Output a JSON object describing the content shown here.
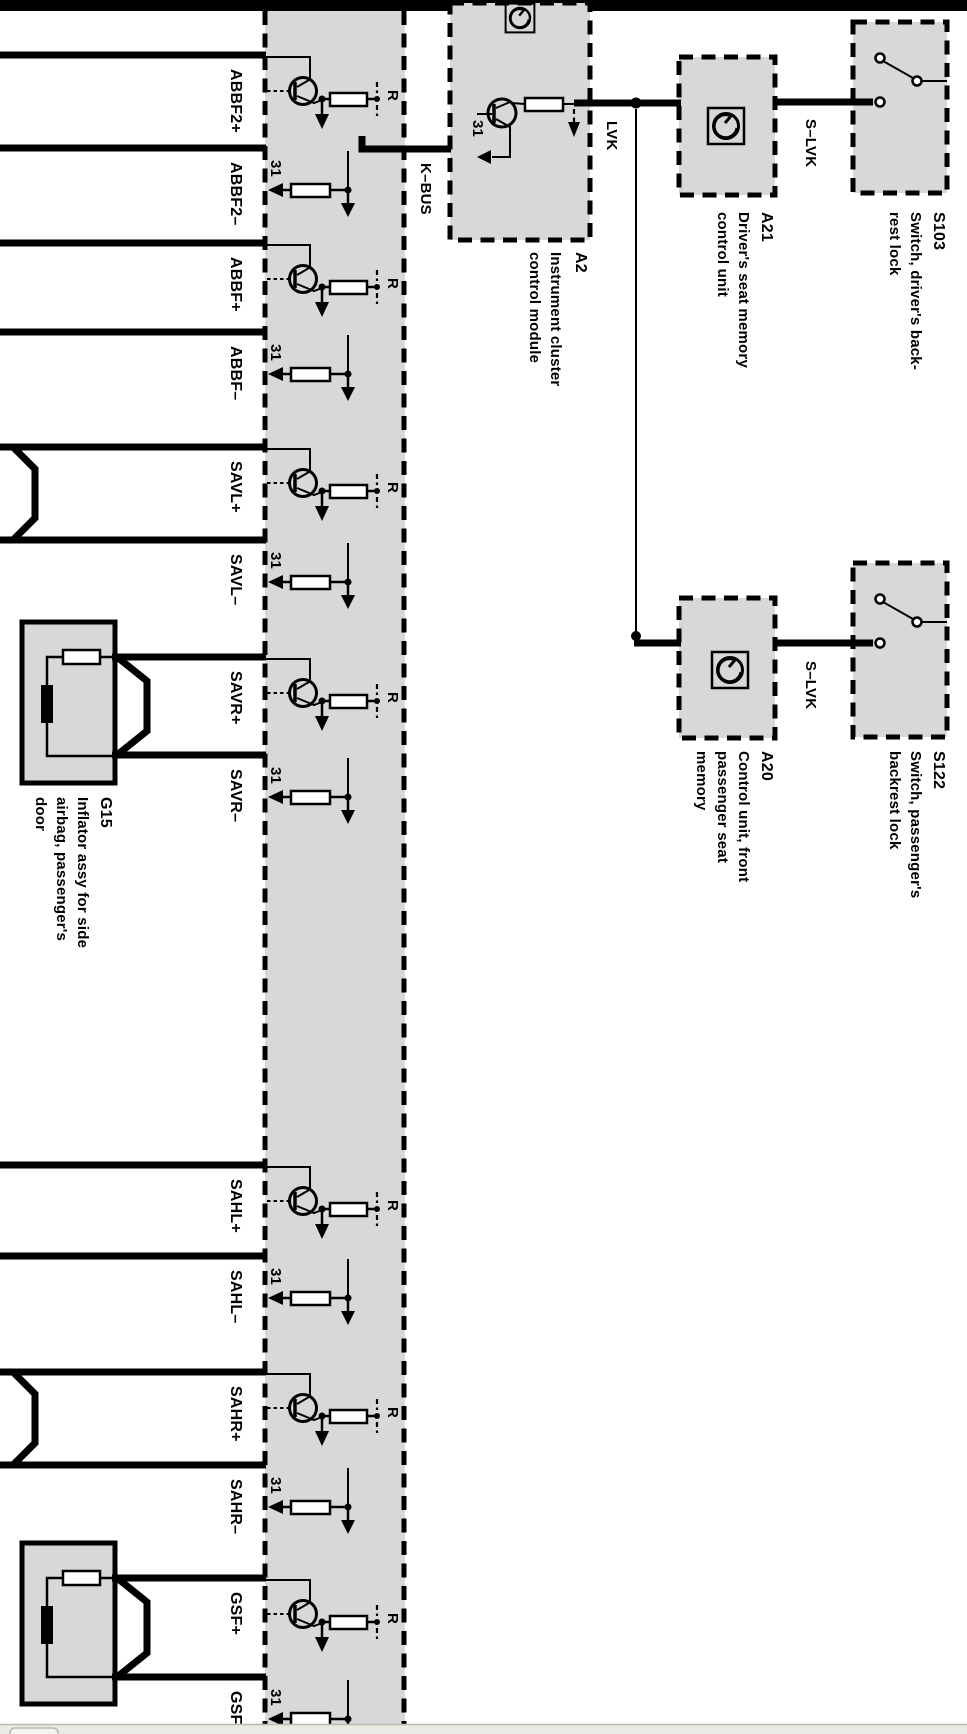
{
  "diagram": {
    "pins": [
      "ABBF2+",
      "ABBF2–",
      "ABBF+",
      "ABBF–",
      "SAVL+",
      "SAVL–",
      "SAVR+",
      "SAVR–",
      "SAHL+",
      "SAHL–",
      "SAHR+",
      "SAHR–",
      "GSF+",
      "GSF–"
    ],
    "wire_labels": {
      "kbus": "K–BUS",
      "lvk": "LVK",
      "slvk_driver": "S–LVK",
      "slvk_passenger": "S–LVK"
    },
    "terminal_labels": {
      "ground": "31",
      "resistance": "R"
    },
    "components": {
      "a2": {
        "lines": [
          "A2",
          "Instrument cluster",
          "control module"
        ]
      },
      "a21": {
        "lines": [
          "A21",
          "Driver's seat memory",
          "control unit"
        ]
      },
      "s103": {
        "lines": [
          "S103",
          "Switch, driver's back-",
          "rest lock"
        ]
      },
      "a20": {
        "lines": [
          "A20",
          "Control unit, front",
          "passenger seat",
          "memory"
        ]
      },
      "s122": {
        "lines": [
          "S122",
          "Switch, passenger's",
          "backrest lock"
        ]
      },
      "g15": {
        "lines": [
          "G15",
          "Inflator assy for side",
          "airbag, passenger's",
          "door"
        ]
      }
    },
    "colors": {
      "module_fill": "#d8d8d8",
      "line": "#000000",
      "footer_strip": "#ebe9e4"
    }
  }
}
